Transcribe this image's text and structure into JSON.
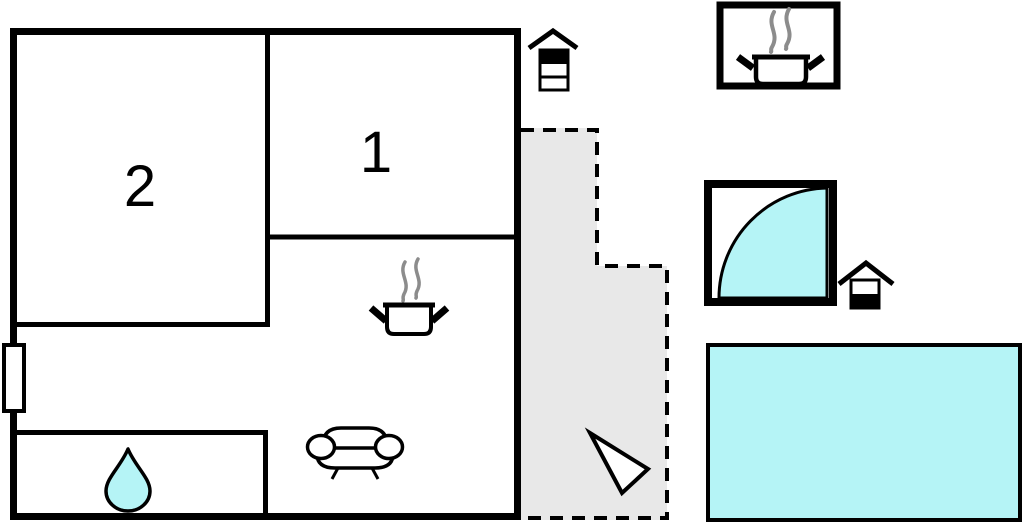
{
  "page": {
    "title": "Property floor plan",
    "background": "#ffffff"
  },
  "colors": {
    "wall": "#000000",
    "white": "#ffffff",
    "water": "#b5f4f6",
    "terrace_fill": "#e8e8e8",
    "steam": "#8c8c8c"
  },
  "rooms": [
    {
      "id": "room-2",
      "label": "2"
    },
    {
      "id": "room-1",
      "label": "1"
    }
  ],
  "symbols": {
    "kitchen": "cooking-pot-with-steam",
    "living_room": "sofa",
    "bathroom": "water-drop",
    "terrace": "dashed-outline-with-north-arrow",
    "grill_near_house": "grill-hut",
    "grill_near_hot_tub": "grill-hut",
    "outdoor_kitchen": "cooking-pot-with-steam-in-box",
    "hot_tub": "quarter-circle-water-basin",
    "pool": "swimming-pool-rectangle"
  }
}
